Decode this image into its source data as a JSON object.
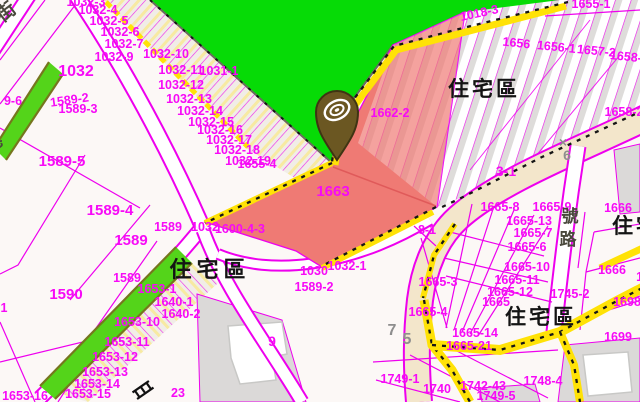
{
  "map": {
    "type": "cadastral-zoning-map",
    "colors": {
      "bg": "#FCF8F6",
      "line": "#EE00EE",
      "green": "#06DB06",
      "stripGreen": "#54D41A",
      "olive": "#76761E",
      "yellow": "#FFE206",
      "salmon": "#EF7A74",
      "beige": "#F3E6CB",
      "roadWhite": "#FFFFFF",
      "grayParcel": "#DBD9D8",
      "black": "#161616",
      "grayLine": "#6B6B5E",
      "redLine": "#E05A5A",
      "building": "#FFFFFF",
      "buildingStroke": "#C8C8C6",
      "hatchGray": "#DEDCDA",
      "parcelLabel": "#F70AF7",
      "zoneLabel": "#141414",
      "roadLabel": "#49483C",
      "markLabel": "#8E8E8E",
      "pinBody": "#6B5722",
      "pinOutline": "#3F3413"
    },
    "styles": {
      "parcel": {
        "c": "#F70AF7",
        "s": 12.5,
        "w": "bold",
        "name": "parcel-label"
      },
      "zone": {
        "c": "#141414",
        "s": 21,
        "w": "bold",
        "ls": 3,
        "name": "zone-label"
      },
      "road": {
        "c": "#49483C",
        "s": 17,
        "w": "bold",
        "name": "road-name-label"
      },
      "mark": {
        "c": "#8E8E8E",
        "s": 14,
        "w": "bold",
        "name": "section-mark-label"
      }
    },
    "labels": {
      "parcels": [
        {
          "t": "1032-3",
          "x": 86,
          "y": 6
        },
        {
          "t": "1032-4",
          "x": 98,
          "y": 14
        },
        {
          "t": "1032-5",
          "x": 109,
          "y": 25
        },
        {
          "t": "1032-6",
          "x": 120,
          "y": 36
        },
        {
          "t": "1032-7",
          "x": 124,
          "y": 48
        },
        {
          "t": "1032-9",
          "x": 114,
          "y": 61
        },
        {
          "t": "1032-10",
          "x": 166,
          "y": 58
        },
        {
          "t": "1032",
          "x": 76,
          "y": 76,
          "s": 16
        },
        {
          "t": "1032-11",
          "x": 181,
          "y": 74
        },
        {
          "t": "1031-1",
          "x": 219,
          "y": 75
        },
        {
          "t": "1032-12",
          "x": 181,
          "y": 89
        },
        {
          "t": "1032-13",
          "x": 189,
          "y": 103
        },
        {
          "t": "1032-14",
          "x": 200,
          "y": 115
        },
        {
          "t": "1032-15",
          "x": 211,
          "y": 126
        },
        {
          "t": "1032-16",
          "x": 220,
          "y": 134
        },
        {
          "t": "1032-17",
          "x": 229,
          "y": 144
        },
        {
          "t": "1032-18",
          "x": 237,
          "y": 154
        },
        {
          "t": "1032-19",
          "x": 248,
          "y": 165
        },
        {
          "t": "1655-4",
          "x": 257,
          "y": 168
        },
        {
          "t": "9-6",
          "x": 13,
          "y": 105
        },
        {
          "t": "1589-2",
          "x": 70,
          "y": 104,
          "r": -8
        },
        {
          "t": "1589-3",
          "x": 78,
          "y": 113
        },
        {
          "t": "1589-5",
          "x": 62,
          "y": 166,
          "s": 15
        },
        {
          "t": "1589-4",
          "x": 110,
          "y": 215,
          "s": 15
        },
        {
          "t": "1589",
          "x": 168,
          "y": 231
        },
        {
          "t": "1589",
          "x": 131,
          "y": 245,
          "s": 15
        },
        {
          "t": "1589",
          "x": 127,
          "y": 282
        },
        {
          "t": "1590",
          "x": 66,
          "y": 299,
          "s": 15
        },
        {
          "t": "1",
          "x": 4,
          "y": 312
        },
        {
          "t": "1032",
          "x": 205,
          "y": 231
        },
        {
          "t": "1600-4-3",
          "x": 240,
          "y": 233
        },
        {
          "t": "1030",
          "x": 314,
          "y": 275
        },
        {
          "t": "1032-1",
          "x": 347,
          "y": 270
        },
        {
          "t": "1589-2",
          "x": 314,
          "y": 291
        },
        {
          "t": "1640-1",
          "x": 174,
          "y": 306
        },
        {
          "t": "1640-2",
          "x": 181,
          "y": 318
        },
        {
          "t": "1653-1",
          "x": 157,
          "y": 293
        },
        {
          "t": "1653-10",
          "x": 137,
          "y": 326
        },
        {
          "t": "1653-11",
          "x": 127,
          "y": 346
        },
        {
          "t": "1653-12",
          "x": 115,
          "y": 361
        },
        {
          "t": "1653-13",
          "x": 105,
          "y": 376
        },
        {
          "t": "1653-14",
          "x": 97,
          "y": 388
        },
        {
          "t": "1653-15",
          "x": 88,
          "y": 398
        },
        {
          "t": "1653-16",
          "x": 25,
          "y": 400
        },
        {
          "t": "23",
          "x": 178,
          "y": 397
        },
        {
          "t": "9",
          "x": 272,
          "y": 346,
          "s": 14
        },
        {
          "t": "1663",
          "x": 333,
          "y": 196,
          "s": 15
        },
        {
          "t": "1662-2",
          "x": 390,
          "y": 117
        },
        {
          "t": "1018-3",
          "x": 480,
          "y": 17,
          "r": -12
        },
        {
          "t": "1655-1",
          "x": 591,
          "y": 8
        },
        {
          "t": "1656",
          "x": 516,
          "y": 47,
          "r": 6
        },
        {
          "t": "1656-1",
          "x": 556,
          "y": 51,
          "r": 6
        },
        {
          "t": "1657-2",
          "x": 596,
          "y": 55,
          "r": 6
        },
        {
          "t": "1658-1",
          "x": 629,
          "y": 61,
          "r": 6
        },
        {
          "t": "1658-2",
          "x": 624,
          "y": 116
        },
        {
          "t": "1665-8",
          "x": 500,
          "y": 211
        },
        {
          "t": "1665-9",
          "x": 552,
          "y": 211
        },
        {
          "t": "1665-13",
          "x": 529,
          "y": 225
        },
        {
          "t": "1665-7",
          "x": 533,
          "y": 237
        },
        {
          "t": "1665-6",
          "x": 527,
          "y": 251
        },
        {
          "t": "1665-10",
          "x": 527,
          "y": 271
        },
        {
          "t": "1665-11",
          "x": 517,
          "y": 284
        },
        {
          "t": "1665-12",
          "x": 510,
          "y": 296
        },
        {
          "t": "1665",
          "x": 496,
          "y": 306
        },
        {
          "t": "1745-2",
          "x": 570,
          "y": 298
        },
        {
          "t": "1665-3",
          "x": 438,
          "y": 286
        },
        {
          "t": "1665-4",
          "x": 428,
          "y": 316
        },
        {
          "t": "1665-14",
          "x": 475,
          "y": 337
        },
        {
          "t": "1665-21",
          "x": 469,
          "y": 350
        },
        {
          "t": "1666",
          "x": 618,
          "y": 212
        },
        {
          "t": "1666",
          "x": 612,
          "y": 274
        },
        {
          "t": "1666",
          "x": 650,
          "y": 281
        },
        {
          "t": "1698",
          "x": 627,
          "y": 306
        },
        {
          "t": "1699",
          "x": 618,
          "y": 341
        },
        {
          "t": "3-1",
          "x": 506,
          "y": 176,
          "s": 14
        },
        {
          "t": "8-1",
          "x": 427,
          "y": 234
        },
        {
          "t": "1749-1",
          "x": 400,
          "y": 383
        },
        {
          "t": "1740",
          "x": 437,
          "y": 393
        },
        {
          "t": "1742-43",
          "x": 483,
          "y": 390
        },
        {
          "t": "1748-4",
          "x": 543,
          "y": 385
        },
        {
          "t": "1749-5",
          "x": 496,
          "y": 400
        }
      ],
      "zones": [
        {
          "t": "住宅區",
          "x": 210,
          "y": 277,
          "s": 22,
          "ls": 5
        },
        {
          "t": "住宅區",
          "x": 484,
          "y": 96,
          "s": 21,
          "ls": 3
        },
        {
          "t": "住宅區",
          "x": 541,
          "y": 324,
          "s": 21,
          "ls": 3
        },
        {
          "t": "住宅",
          "x": 636,
          "y": 233,
          "s": 21,
          "ls": 3
        }
      ],
      "road_names": [
        {
          "t": "街",
          "x": 10,
          "y": 17,
          "s": 19,
          "r": -38
        },
        {
          "t": "巷",
          "x": -2,
          "y": 148,
          "s": 16,
          "r": -38
        },
        {
          "t": "號",
          "x": 570,
          "y": 222,
          "s": 17
        },
        {
          "t": "路",
          "x": 568,
          "y": 245,
          "s": 17
        }
      ],
      "section_marks": [
        {
          "t": "×",
          "x": 563,
          "y": 147
        },
        {
          "t": "6",
          "x": 567,
          "y": 160
        },
        {
          "t": "7",
          "x": 392,
          "y": 335,
          "s": 16
        },
        {
          "t": "5",
          "x": 407,
          "y": 344,
          "s": 16
        }
      ]
    },
    "marker": {
      "name": "map-pin-marker",
      "x": 337,
      "y": 160,
      "description": "dark olive pin with white rings"
    }
  }
}
